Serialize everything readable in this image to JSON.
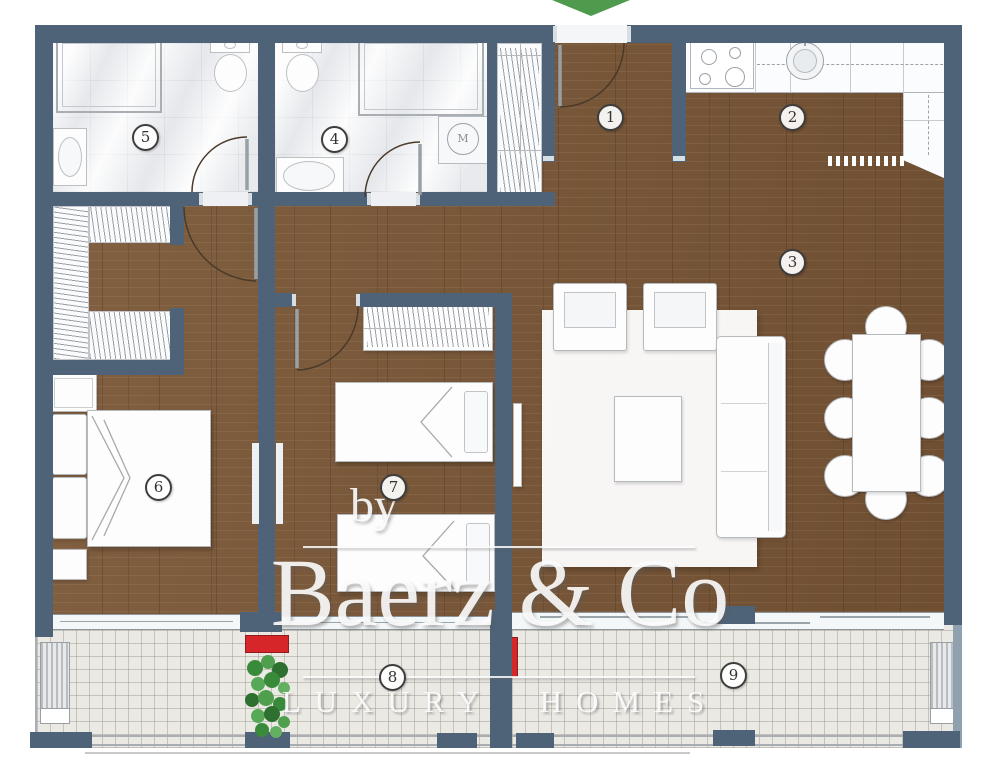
{
  "meta": {
    "type": "apartment-floor-plan"
  },
  "watermark": {
    "by": "by",
    "brand": "Baerz & Co",
    "tagline": "LUXURY HOMES"
  },
  "rooms": [
    {
      "number": "1",
      "name": "entry-hall",
      "x": 610,
      "y": 117
    },
    {
      "number": "2",
      "name": "kitchen",
      "x": 792,
      "y": 117
    },
    {
      "number": "3",
      "name": "living-room",
      "x": 792,
      "y": 262
    },
    {
      "number": "4",
      "name": "bathroom",
      "x": 334,
      "y": 139
    },
    {
      "number": "5",
      "name": "bathroom",
      "x": 145,
      "y": 137
    },
    {
      "number": "6",
      "name": "bedroom",
      "x": 158,
      "y": 487
    },
    {
      "number": "7",
      "name": "bedroom",
      "x": 393,
      "y": 487
    },
    {
      "number": "8",
      "name": "balcony",
      "x": 392,
      "y": 677
    },
    {
      "number": "9",
      "name": "balcony",
      "x": 733,
      "y": 675
    }
  ],
  "labels": {
    "washing_machine": "M"
  },
  "colors": {
    "wall": "#4e6378",
    "wood": "#7b5737",
    "marble": "#f1f2f4",
    "tile": "#ebe9e4",
    "red": "#d6262a",
    "green": "#4e9b4e"
  }
}
